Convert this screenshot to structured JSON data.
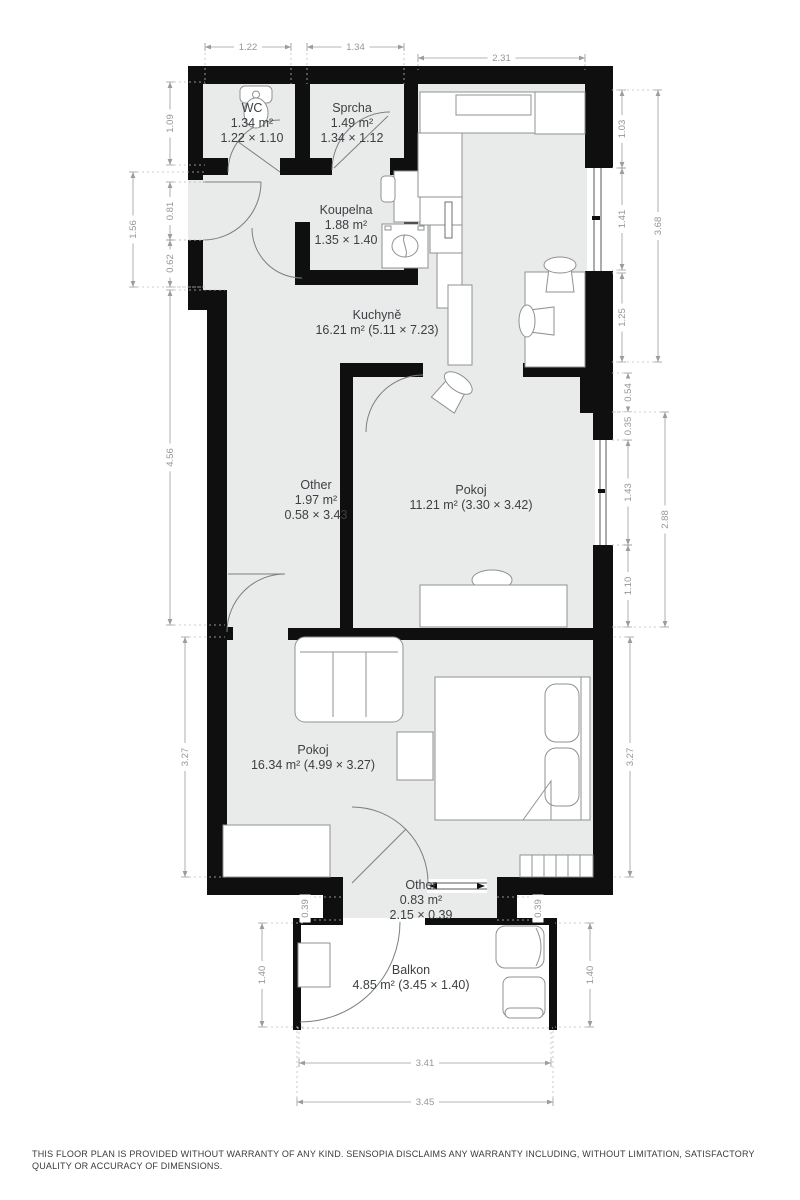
{
  "floor_plan": {
    "rooms": [
      {
        "id": "wc",
        "lines": [
          "WC",
          "1.34 m²",
          "1.22 × 1.10"
        ]
      },
      {
        "id": "sprcha",
        "lines": [
          "Sprcha",
          "1.49 m²",
          "1.34 × 1.12"
        ]
      },
      {
        "id": "koupelna",
        "lines": [
          "Koupelna",
          "1.88 m²",
          "1.35 × 1.40"
        ]
      },
      {
        "id": "kuchyne",
        "lines": [
          "Kuchyně",
          "16.21 m² (5.11 × 7.23)"
        ]
      },
      {
        "id": "other-hall",
        "lines": [
          "Other",
          "1.97 m²",
          "0.58 × 3.43"
        ]
      },
      {
        "id": "pokoj-east",
        "lines": [
          "Pokoj",
          "11.21 m² (3.30 × 3.42)"
        ]
      },
      {
        "id": "pokoj-south",
        "lines": [
          "Pokoj",
          "16.34 m² (4.99 × 3.27)"
        ]
      },
      {
        "id": "other-passage",
        "lines": [
          "Other",
          "0.83 m²",
          "2.15 × 0.39"
        ]
      },
      {
        "id": "balkon",
        "lines": [
          "Balkon",
          "4.85 m² (3.45 × 1.40)"
        ]
      }
    ],
    "dimensions": [
      "1.22",
      "1.34",
      "2.31",
      "1.09",
      "0.81",
      "0.62",
      "1.56",
      "4.56",
      "3.27",
      "1.03",
      "1.41",
      "1.25",
      "3.68",
      "0.54",
      "0.35",
      "1.43",
      "1.10",
      "2.88",
      "3.27",
      "1.40",
      "1.40",
      "0.39",
      "0.39",
      "3.41",
      "3.45"
    ],
    "colors": {
      "wall": "#0f0f0f",
      "floor": "#e9eaea",
      "dim": "#97999b",
      "label": "#3d4043"
    },
    "disclaimer": "THIS FLOOR PLAN IS PROVIDED WITHOUT WARRANTY OF ANY KIND. SENSOPIA DISCLAIMS ANY WARRANTY INCLUDING, WITHOUT LIMITATION, SATISFACTORY QUALITY OR ACCURACY OF DIMENSIONS."
  }
}
